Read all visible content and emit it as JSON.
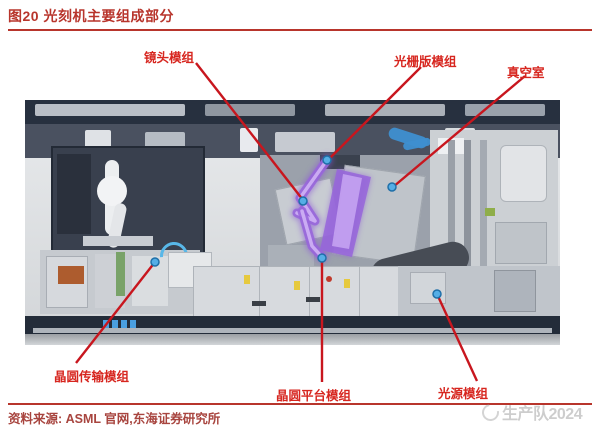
{
  "figure": {
    "title": "图20 光刻机主要组成部分",
    "source_note": "资料来源: ASML 官网,东海证券研究所",
    "watermark": "生产队2024"
  },
  "callouts": {
    "lens": "镜头模组",
    "reticle": "光栅版模组",
    "vacuum": "真空室",
    "wafer_transfer": "晶圆传输模组",
    "wafer_stage": "晶圆平台模组",
    "light_source": "光源模组"
  },
  "colors": {
    "title_red": "#b8352c",
    "label_red": "#d7261f",
    "callout_line_red": "#c8161e",
    "beam_purple": "#9765db",
    "dot_blue": "#55aee6",
    "machine_frame_navy": "#27303f"
  }
}
